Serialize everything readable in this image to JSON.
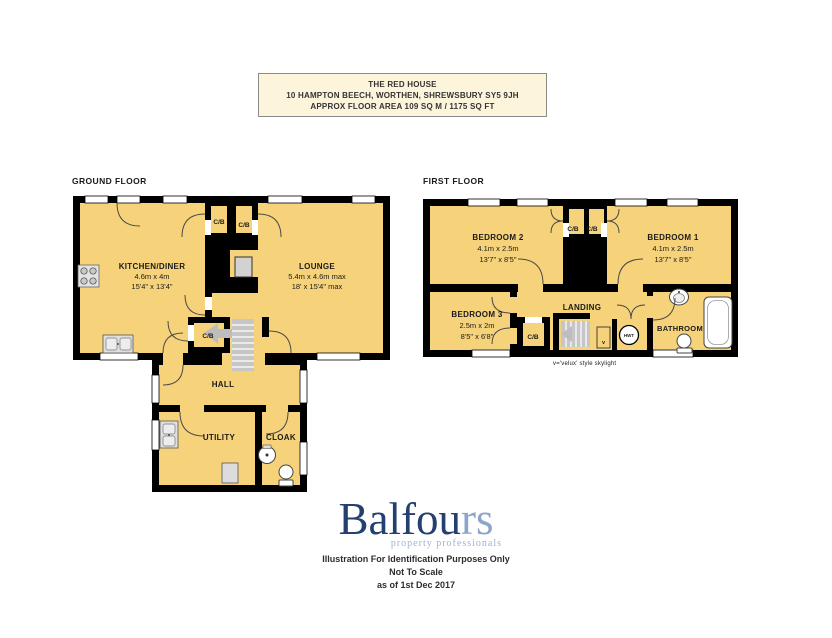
{
  "title_box": {
    "line1": "THE RED HOUSE",
    "line2": "10 HAMPTON BEECH, WORTHEN, SHREWSBURY SY5 9JH",
    "line3": "APPROX FLOOR AREA 109 SQ M / 1175 SQ FT"
  },
  "floors": {
    "ground_label": "GROUND FLOOR",
    "first_label": "FIRST FLOOR"
  },
  "ground": {
    "kitchen": {
      "name": "KITCHEN/DINER",
      "metric": "4.6m x 4m",
      "imperial": "15'4\" x 13'4\""
    },
    "lounge": {
      "name": "LOUNGE",
      "metric": "5.4m x 4.6m max",
      "imperial": "18' x 15'4\" max"
    },
    "cb1": "C/B",
    "cb2": "C/B",
    "cb3": "C/B",
    "hall": "HALL",
    "utility": "UTILITY",
    "cloak": "CLOAK"
  },
  "first": {
    "bedroom2": {
      "name": "BEDROOM 2",
      "metric": "4.1m x 2.5m",
      "imperial": "13'7\" x 8'5\""
    },
    "bedroom1": {
      "name": "BEDROOM 1",
      "metric": "4.1m x 2.5m",
      "imperial": "13'7\" x 8'5\""
    },
    "bedroom3": {
      "name": "BEDROOM 3",
      "metric": "2.5m x 2m",
      "imperial": "8'5\" x 6'8\""
    },
    "landing": "LANDING",
    "bathroom": "BATHROOM",
    "cb1": "C/B",
    "cb2": "C/B",
    "cb3": "C/B",
    "hwt": "HWT",
    "skylight_marker": "v",
    "skylight_note": "v='velux' style skylight"
  },
  "logo": {
    "name_dark": "Balfou",
    "name_light": "rs",
    "tagline": "property professionals",
    "dark_color": "#24406E",
    "light_color": "#8CA6C9"
  },
  "footer": {
    "line1": "Illustration For Identification Purposes Only",
    "line2": "Not To Scale",
    "line3": "as of 1st Dec 2017"
  },
  "colors": {
    "room_fill": "#F6D37A",
    "wall": "#000000",
    "title_bg": "#FCF5DB",
    "fixture_grey": "#DCDCDC",
    "stairs_grey": "#C6C6C6"
  }
}
